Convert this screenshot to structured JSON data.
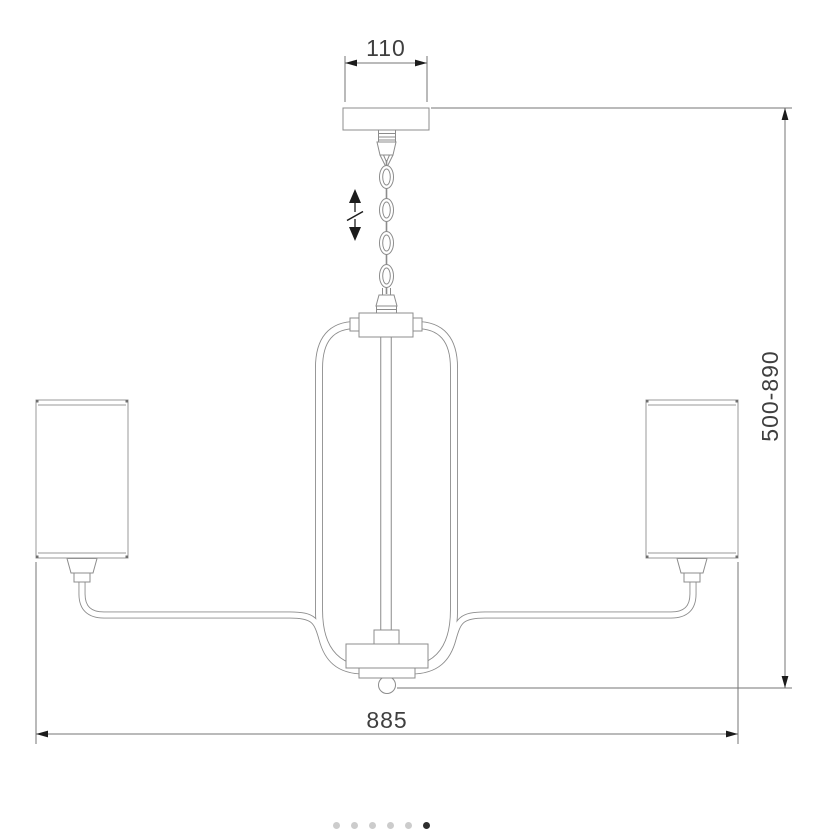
{
  "drawing": {
    "dimensions": {
      "canopy_width": "110",
      "height_range": "500-890",
      "overall_width": "885"
    },
    "symbols": {
      "height_adjustable": "double-arrow-with-break"
    }
  },
  "carousel": {
    "dots_total": 6,
    "active_index": 5
  },
  "colors": {
    "line": "#8c8c8c",
    "dimension_line": "#757575",
    "arrow": "#1c1c1c",
    "text": "#3f3f3f",
    "dot_inactive": "#cccccc",
    "dot_active": "#2e2e2e"
  }
}
